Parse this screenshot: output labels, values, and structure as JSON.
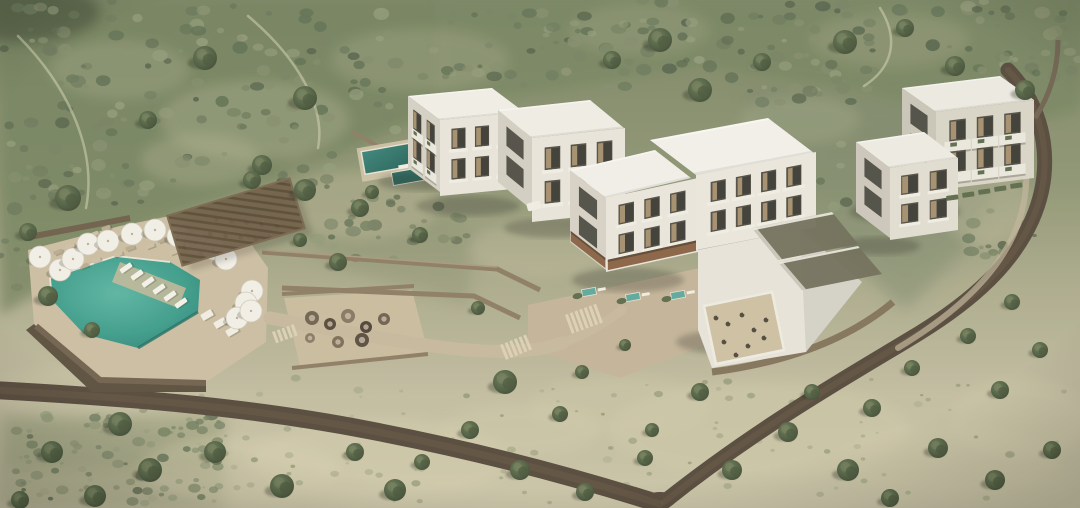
{
  "meta": {
    "type": "architectural-aerial-render",
    "title": "Aerial 3D rendering of a hillside resort with infinity pool, white guest blocks and olive grove"
  },
  "scene": {
    "colors": {
      "scrub_green": "#75815f",
      "scrub_light": "#a8ae8c",
      "dry_field": "#c3bda0",
      "road_brown": "#55483a",
      "path_beige": "#c7b89c",
      "deck_sand": "#cbbda1",
      "pool_water": "#3d9c8a",
      "pool_deep": "#2a8175",
      "building_white": "#eae7de",
      "building_shade": "#d2cdc1",
      "window_dark": "#514d45",
      "curtain_tan": "#b39a74",
      "pergola_brown": "#6e5c45",
      "canopy_slat": "#9a987f",
      "awning_wood": "#8a6143",
      "umbrella_white": "#f2efe7",
      "stone_wall": "#8d7c62",
      "tree_green": "#4c5b40"
    },
    "landscape": {
      "terrain": "mediterranean scrub hillside",
      "grove": "olive trees",
      "roads": "dirt access roads"
    },
    "resort": {
      "pool": {
        "type": "infinity pool",
        "umbrella_count": 15,
        "in_pool_loungers": 6
      },
      "structures": [
        "restaurant pergola",
        "fire-pit lounge terrace",
        "guest block A",
        "guest block B",
        "main building",
        "rooftop-canopy restaurant building",
        "east block",
        "far-east block"
      ],
      "amenities": [
        "sun loungers",
        "daybeds",
        "plunge pools",
        "stone retaining walls",
        "stepped walkways",
        "small upper pool"
      ]
    }
  }
}
